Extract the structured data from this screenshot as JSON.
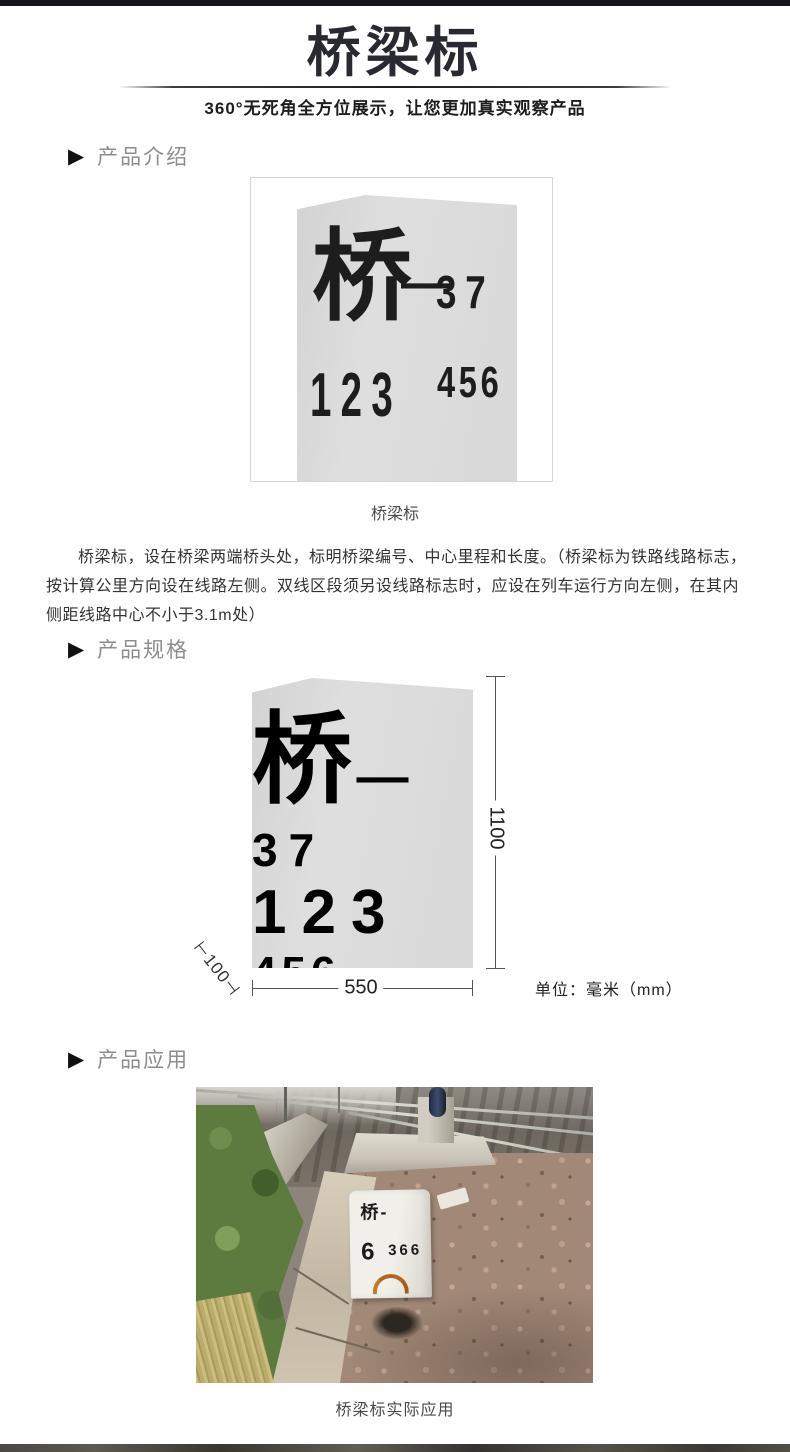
{
  "header": {
    "title": "桥梁标",
    "subtitle": "360°无死角全方位展示，让您更加真实观察产品"
  },
  "icons": {
    "section_marker": "▶"
  },
  "sections": {
    "intro": "产品介绍",
    "spec": "产品规格",
    "app": "产品应用"
  },
  "marker_sign": {
    "char": "桥",
    "dash": "—",
    "serial": "37",
    "number": "123",
    "number_small": "456"
  },
  "intro": {
    "caption": "桥梁标",
    "description": "桥梁标，设在桥梁两端桥头处，标明桥梁编号、中心里程和长度。（桥梁标为铁路线路标志，按计算公里方向设在线路左侧。双线区段须另设线路标志时，应设在列车运行方向左侧，在其内侧距线路中心不小于3.1m处）"
  },
  "spec": {
    "dim_height": "1100",
    "dim_width": "550",
    "dim_depth": "⊢100⊣",
    "unit_label": "单位：毫米（mm）"
  },
  "app": {
    "stone_title": "桥-",
    "stone_number": "6",
    "stone_number_small": "366",
    "caption": "桥梁标实际应用"
  },
  "colors": {
    "top_bar": "#15151b",
    "title_text": "#292932",
    "section_label": "#8d8d8d",
    "stone_fill": "#d9d9d9",
    "body_text": "#333333",
    "dimension_line": "#555555",
    "signal_blue": "#2c3a56",
    "ballast": "#a18877",
    "vegetation": "#5d7b3e"
  }
}
